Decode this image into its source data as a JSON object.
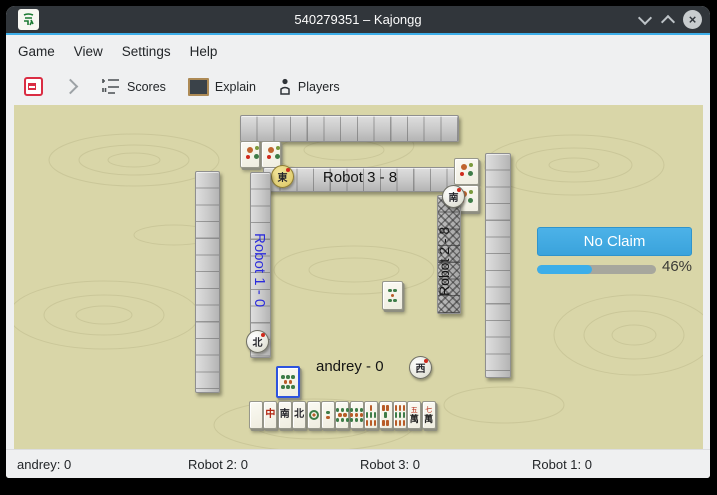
{
  "window": {
    "title": "540279351 – Kajongg",
    "app_icon": "green-dragon-tile-icon",
    "controls": {
      "minimize": "chevron-down",
      "maximize": "chevron-up",
      "close": "×"
    }
  },
  "menu": {
    "items": [
      {
        "label": "Game"
      },
      {
        "label": "View"
      },
      {
        "label": "Settings"
      },
      {
        "label": "Help"
      }
    ]
  },
  "toolbar": {
    "buttons": [
      {
        "name": "abort-game",
        "label": ""
      },
      {
        "name": "step-forward",
        "label": ""
      },
      {
        "name": "scores",
        "label": "Scores"
      },
      {
        "name": "explain",
        "label": "Explain"
      },
      {
        "name": "players",
        "label": "Players"
      }
    ]
  },
  "claim": {
    "button_label": "No Claim"
  },
  "progress": {
    "percent": 46,
    "label": "46%"
  },
  "players": {
    "top": {
      "name": "Robot 3",
      "label": "Robot 3 - 8",
      "wind_char": "東",
      "wind_letter": "E",
      "dealer": true
    },
    "right": {
      "name": "Robot 2",
      "label": "Robot 2 - 8",
      "wind_char": "南",
      "wind_letter": "S",
      "dealer": false
    },
    "bottom": {
      "name": "andrey",
      "label": "andrey - 0",
      "wind_char": "西",
      "wind_letter": "W",
      "dealer": false
    },
    "left": {
      "name": "Robot 1",
      "label": "Robot 1 - 0",
      "wind_char": "北",
      "wind_letter": "N",
      "dealer": false,
      "label_color": "#2b2bdc"
    }
  },
  "bonus_tiles": {
    "top": [
      {
        "type": "flower"
      },
      {
        "type": "flower"
      }
    ],
    "right": [
      {
        "type": "flower"
      },
      {
        "type": "flower"
      }
    ]
  },
  "discards": [
    {
      "type": "dots",
      "value": 5,
      "focused": false
    },
    {
      "type": "dots",
      "value": 8,
      "focused": true
    }
  ],
  "hand": {
    "tiles": [
      {
        "type": "blank",
        "name": "white-dragon"
      },
      {
        "type": "dragon",
        "glyph": "中",
        "color": "#b02310",
        "name": "red-dragon"
      },
      {
        "type": "wind",
        "glyph": "南",
        "letter": "S",
        "name": "south-wind"
      },
      {
        "type": "wind",
        "glyph": "北",
        "letter": "N",
        "name": "north-wind"
      },
      {
        "type": "dots",
        "value": 1
      },
      {
        "type": "dots",
        "value": 2
      },
      {
        "type": "dots",
        "value": 8
      },
      {
        "type": "dots",
        "value": 9
      },
      {
        "type": "bamboo",
        "value": 7
      },
      {
        "type": "bamboo",
        "value": 5
      },
      {
        "type": "bamboo",
        "value": 9
      },
      {
        "type": "character",
        "value": 5,
        "glyph": "萬",
        "num_glyph": "五"
      },
      {
        "type": "character",
        "value": 7,
        "glyph": "萬",
        "num_glyph": "七"
      }
    ]
  },
  "statusbar": {
    "items": [
      {
        "label": "andrey: 0"
      },
      {
        "label": "Robot 2: 0"
      },
      {
        "label": "Robot 3: 0"
      },
      {
        "label": "Robot 1: 0"
      }
    ]
  },
  "colors": {
    "accent": "#3daee9",
    "board": "#d9d6a8",
    "titlebar": "#31363b",
    "claim_button": "#3daee9"
  }
}
